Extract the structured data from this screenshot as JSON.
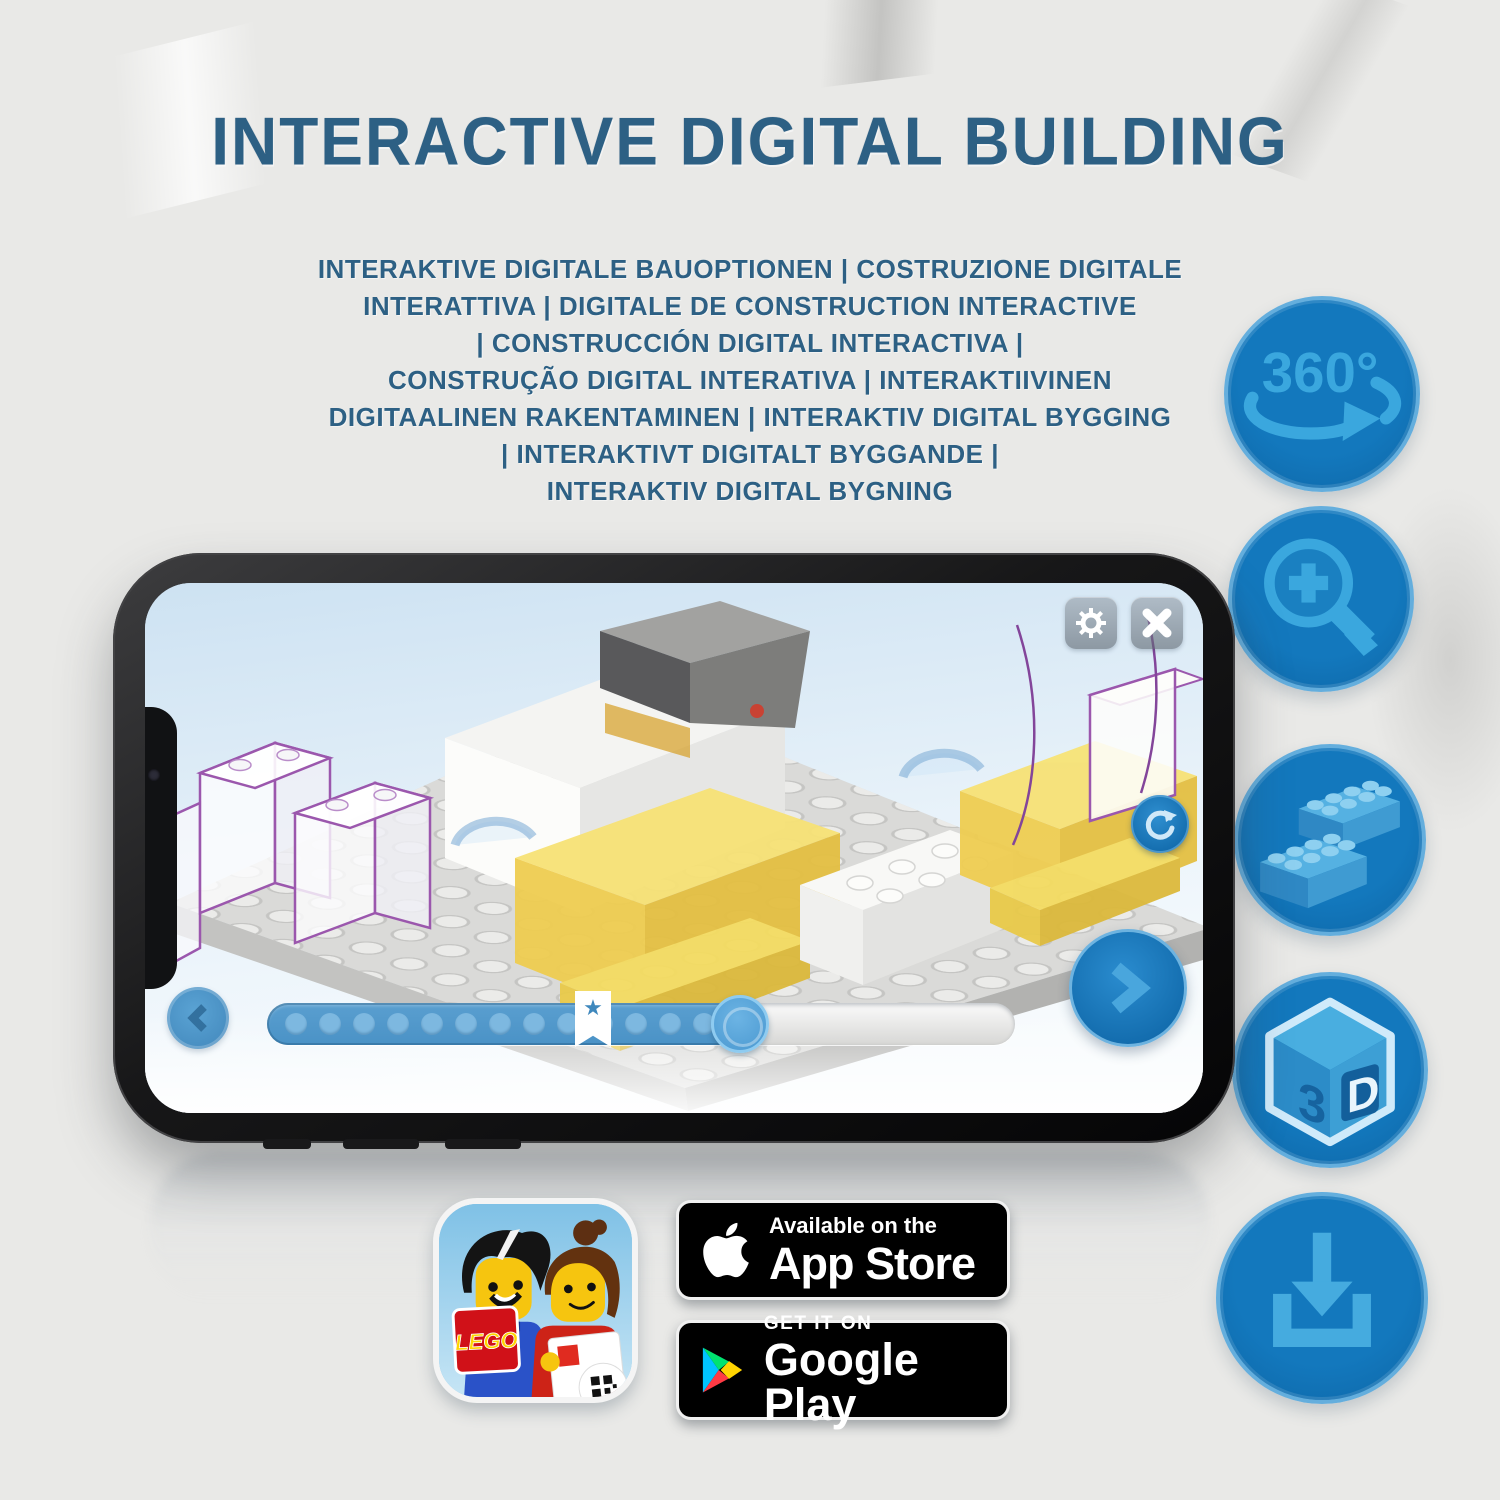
{
  "title": "INTERACTIVE DIGITAL BUILDING",
  "subtitle_lines": [
    "INTERAKTIVE DIGITALE BAUOPTIONEN | COSTRUZIONE DIGITALE",
    "INTERATTIVA | DIGITALE DE CONSTRUCTION INTERACTIVE",
    "| CONSTRUCCIÓN DIGITAL INTERACTIVA |",
    "CONSTRUÇÃO DIGITAL INTERATIVA | INTERAKTIIVINEN",
    "DIGITAALINEN RAKENTAMINEN | INTERAKTIV DIGITAL BYGGING",
    "| INTERAKTIVT DIGITALT BYGGANDE |",
    "INTERAKTIV DIGITAL BYGNING"
  ],
  "feature_icons": {
    "rotation_label": "360°",
    "cube_left": "3",
    "cube_right": "D"
  },
  "phone": {
    "progress": {
      "dot_count": 13
    }
  },
  "badges": {
    "app_store": {
      "tagline": "Available on the",
      "store": "App Store"
    },
    "google_play": {
      "tagline": "GET IT ON",
      "store": "Google Play"
    }
  },
  "app_icon": {
    "logo_text": "LEGO"
  },
  "colors": {
    "heading": "#2d6084",
    "circle_fill": "#1173b8",
    "circle_glyph": "#3aa7de",
    "circle_ring": "#64aedd",
    "progress_fill": "#4d96ca",
    "brick_highlight_yellow": "#f2d45a",
    "outline_purple": "#9b57ad"
  }
}
